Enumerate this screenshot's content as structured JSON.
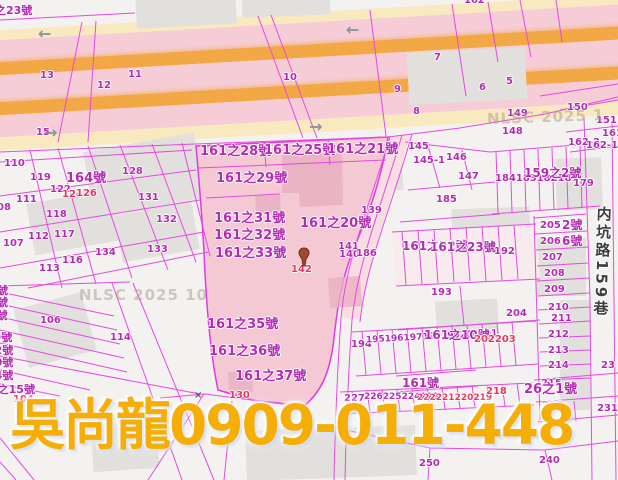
{
  "ad_overlay": {
    "text": "吳尚龍0909-011-448",
    "color": "#f4ae06"
  },
  "road_name": {
    "full": "内坑路159巷",
    "prefix": "内坑路",
    "number": "159",
    "suffix": "巷"
  },
  "x_mark": {
    "text": "×"
  },
  "marker": {
    "name": "location-pin",
    "color": "#9c4a32"
  },
  "colors": {
    "parcel_line": "#e54ae0",
    "label_magenta": "#b32ab3",
    "label_red": "#e8355f",
    "highlight_fill": "#f4c9d4",
    "road_orange": "#f2a845",
    "road_pink": "#f6cdd7",
    "road_cream": "#f8e9bf",
    "building_gray": "#e2e0dd",
    "ad_yellow": "#f4ae06"
  },
  "watermarks": [
    {
      "t": "NLSC 2025 1",
      "x": 487,
      "y": 108,
      "r": -2
    },
    {
      "t": "NLSC 2025 10",
      "x": 79,
      "y": 286,
      "r": 0
    }
  ],
  "arrows": [
    {
      "d": "left",
      "x": 38,
      "y": 26
    },
    {
      "d": "left",
      "x": 346,
      "y": 22
    },
    {
      "d": "right",
      "x": 309,
      "y": 119
    },
    {
      "d": "right",
      "x": 44,
      "y": 125
    }
  ],
  "labels": [
    {
      "t": "之23號",
      "x": -5,
      "y": 5,
      "s": 11
    },
    {
      "t": "162",
      "x": 464,
      "y": -4
    },
    {
      "t": "13",
      "x": 40,
      "y": 71
    },
    {
      "t": "12",
      "x": 97,
      "y": 81
    },
    {
      "t": "11",
      "x": 128,
      "y": 70
    },
    {
      "t": "10",
      "x": 283,
      "y": 73
    },
    {
      "t": "9",
      "x": 394,
      "y": 85
    },
    {
      "t": "7",
      "x": 434,
      "y": 53
    },
    {
      "t": "6",
      "x": 479,
      "y": 83
    },
    {
      "t": "5",
      "x": 506,
      "y": 77
    },
    {
      "t": "8",
      "x": 413,
      "y": 107
    },
    {
      "t": "15",
      "x": 36,
      "y": 128
    },
    {
      "t": "150",
      "x": 567,
      "y": 103
    },
    {
      "t": "149",
      "x": 507,
      "y": 109
    },
    {
      "t": "151",
      "x": 596,
      "y": 116
    },
    {
      "t": "148",
      "x": 502,
      "y": 127
    },
    {
      "t": "161",
      "x": 602,
      "y": 129
    },
    {
      "t": "162-2",
      "x": 568,
      "y": 138
    },
    {
      "t": "162-1",
      "x": 586,
      "y": 141
    },
    {
      "t": "145",
      "x": 408,
      "y": 142
    },
    {
      "t": "145-1",
      "x": 413,
      "y": 156
    },
    {
      "t": "146",
      "x": 446,
      "y": 153
    },
    {
      "t": "147",
      "x": 458,
      "y": 172
    },
    {
      "t": "185",
      "x": 436,
      "y": 195
    },
    {
      "t": "184183182181",
      "x": 495,
      "y": 174
    },
    {
      "t": "159之2號",
      "x": 524,
      "y": 167,
      "s": 12
    },
    {
      "t": "179",
      "x": 573,
      "y": 179
    },
    {
      "t": "110",
      "x": 4,
      "y": 159
    },
    {
      "t": "119",
      "x": 30,
      "y": 173
    },
    {
      "t": "164號",
      "x": 66,
      "y": 172,
      "s": 13
    },
    {
      "t": "128",
      "x": 122,
      "y": 167
    },
    {
      "t": "122",
      "x": 50,
      "y": 185
    },
    {
      "t": "124",
      "x": 62,
      "y": 190,
      "c": "r"
    },
    {
      "t": "126",
      "x": 76,
      "y": 189,
      "c": "r"
    },
    {
      "t": "111",
      "x": 16,
      "y": 195
    },
    {
      "t": "08",
      "x": -3,
      "y": 203
    },
    {
      "t": "131",
      "x": 138,
      "y": 193
    },
    {
      "t": "118",
      "x": 46,
      "y": 210
    },
    {
      "t": "132",
      "x": 156,
      "y": 215
    },
    {
      "t": "112",
      "x": 28,
      "y": 232
    },
    {
      "t": "107",
      "x": 3,
      "y": 239
    },
    {
      "t": "117",
      "x": 54,
      "y": 230
    },
    {
      "t": "134",
      "x": 95,
      "y": 248
    },
    {
      "t": "133",
      "x": 147,
      "y": 245
    },
    {
      "t": "116",
      "x": 62,
      "y": 256
    },
    {
      "t": "113",
      "x": 39,
      "y": 264
    },
    {
      "t": "161之28號",
      "x": 200,
      "y": 145,
      "s": 13
    },
    {
      "t": "161之25號",
      "x": 264,
      "y": 144,
      "s": 13
    },
    {
      "t": "161之21號",
      "x": 327,
      "y": 143,
      "s": 13
    },
    {
      "t": "161之29號",
      "x": 216,
      "y": 172,
      "s": 13
    },
    {
      "t": "161之31號",
      "x": 214,
      "y": 212,
      "s": 13
    },
    {
      "t": "161之32號",
      "x": 214,
      "y": 229,
      "s": 13
    },
    {
      "t": "161之33號",
      "x": 215,
      "y": 247,
      "s": 13
    },
    {
      "t": "161之20號",
      "x": 300,
      "y": 217,
      "s": 13
    },
    {
      "t": "161之35號",
      "x": 207,
      "y": 318,
      "s": 13
    },
    {
      "t": "161之36號",
      "x": 209,
      "y": 345,
      "s": 13
    },
    {
      "t": "161之37號",
      "x": 235,
      "y": 370,
      "s": 13
    },
    {
      "t": "142",
      "x": 291,
      "y": 265,
      "c": "r"
    },
    {
      "t": "139",
      "x": 361,
      "y": 206
    },
    {
      "t": "141",
      "x": 338,
      "y": 242
    },
    {
      "t": "140",
      "x": 339,
      "y": 250
    },
    {
      "t": "186",
      "x": 356,
      "y": 249
    },
    {
      "t": "161之22號",
      "x": 402,
      "y": 240,
      "s": 12
    },
    {
      "t": "161之23號",
      "x": 430,
      "y": 241,
      "s": 12
    },
    {
      "t": "192",
      "x": 494,
      "y": 247
    },
    {
      "t": "205",
      "x": 540,
      "y": 221
    },
    {
      "t": "2號",
      "x": 562,
      "y": 219,
      "s": 12
    },
    {
      "t": "206",
      "x": 540,
      "y": 237
    },
    {
      "t": "6號",
      "x": 562,
      "y": 235,
      "s": 12
    },
    {
      "t": "207",
      "x": 542,
      "y": 253
    },
    {
      "t": "208",
      "x": 544,
      "y": 269
    },
    {
      "t": "209",
      "x": 544,
      "y": 285
    },
    {
      "t": "193",
      "x": 431,
      "y": 288
    },
    {
      "t": "106",
      "x": 40,
      "y": 316
    },
    {
      "t": "114",
      "x": 110,
      "y": 333
    },
    {
      "t": "204",
      "x": 506,
      "y": 309
    },
    {
      "t": "210",
      "x": 548,
      "y": 303
    },
    {
      "t": "211",
      "x": 551,
      "y": 314
    },
    {
      "t": "212",
      "x": 548,
      "y": 330
    },
    {
      "t": "213",
      "x": 548,
      "y": 346
    },
    {
      "t": "214",
      "x": 548,
      "y": 361
    },
    {
      "t": "23",
      "x": 601,
      "y": 361
    },
    {
      "t": "194",
      "x": 351,
      "y": 340
    },
    {
      "t": "195196197198199200201",
      "x": 366,
      "y": 333,
      "s": 9,
      "r": -3
    },
    {
      "t": "161之10號",
      "x": 424,
      "y": 329,
      "s": 12
    },
    {
      "t": "202203",
      "x": 474,
      "y": 335,
      "c": "r"
    },
    {
      "t": "號",
      "x": -3,
      "y": 285,
      "s": 11
    },
    {
      "t": "號",
      "x": -3,
      "y": 297,
      "s": 11
    },
    {
      "t": "9號",
      "x": -11,
      "y": 310,
      "s": 11
    },
    {
      "t": "19號",
      "x": -14,
      "y": 332,
      "s": 11
    },
    {
      "t": "之12號",
      "x": -24,
      "y": 345,
      "s": 11
    },
    {
      "t": "之10號",
      "x": -24,
      "y": 357,
      "s": 11
    },
    {
      "t": "之14號",
      "x": -24,
      "y": 370,
      "s": 11
    },
    {
      "t": "5之15號",
      "x": -10,
      "y": 384,
      "s": 11
    },
    {
      "t": "104",
      "x": 13,
      "y": 395,
      "c": "r"
    },
    {
      "t": "130",
      "x": 229,
      "y": 391,
      "c": "r"
    },
    {
      "t": "161號",
      "x": 402,
      "y": 377,
      "s": 12
    },
    {
      "t": "227",
      "x": 344,
      "y": 394
    },
    {
      "t": "226225224223",
      "x": 364,
      "y": 393,
      "s": 9
    },
    {
      "t": "222221220219",
      "x": 417,
      "y": 394,
      "s": 9,
      "c": "r"
    },
    {
      "t": "218",
      "x": 486,
      "y": 387,
      "c": "r"
    },
    {
      "t": "215",
      "x": 541,
      "y": 379
    },
    {
      "t": "26之1號",
      "x": 524,
      "y": 383,
      "s": 13
    },
    {
      "t": "216",
      "x": 542,
      "y": 401
    },
    {
      "t": "231",
      "x": 597,
      "y": 404
    },
    {
      "t": "250",
      "x": 419,
      "y": 459
    },
    {
      "t": "240",
      "x": 539,
      "y": 456
    }
  ]
}
